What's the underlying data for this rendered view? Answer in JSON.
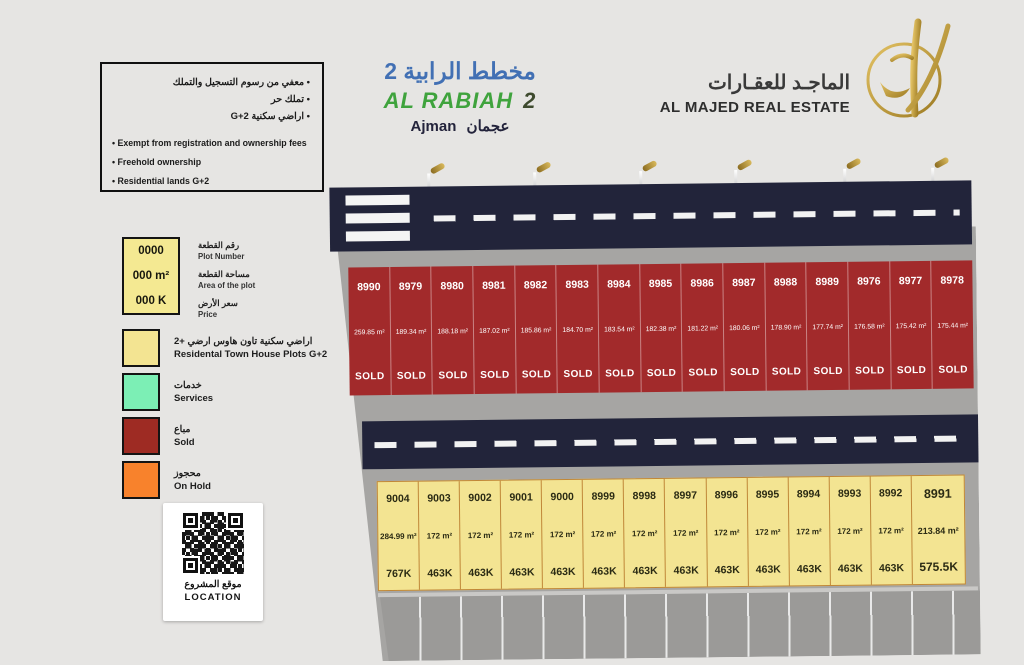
{
  "info_box": {
    "lines_ar": [
      "معفي من رسوم التسجيل والتملك",
      "تملك حر",
      "اراضي سكنية G+2"
    ],
    "lines_en": [
      "Exempt from registration and ownership fees",
      "Freehold ownership",
      "Residential lands G+2"
    ]
  },
  "title": {
    "ar": "مخطط الرابية 2",
    "en": "AL RABIAH",
    "en_num": "2",
    "city": "عجمان  Ajman"
  },
  "brand": {
    "name_ar": "الماجـد للعقـارات",
    "name_en": "AL MAJED REAL ESTATE"
  },
  "legend": {
    "key": {
      "number": "0000",
      "area": "000 m²",
      "price": "000 K",
      "labels": [
        {
          "ar": "رقم القطعة",
          "en": "Plot Number"
        },
        {
          "ar": "مساحة القطعة",
          "en": "Area of the plot"
        },
        {
          "ar": "سعر الأرض",
          "en": "Price"
        }
      ]
    },
    "items": [
      {
        "color": "#F3E492",
        "ar": "اراضي سكنية تاون هاوس ارضي +2",
        "en": "Residental Town House Plots G+2"
      },
      {
        "color": "#7CEFB5",
        "ar": "خدمات",
        "en": "Services"
      },
      {
        "color": "#9E2B23",
        "ar": "مباع",
        "en": "Sold"
      },
      {
        "color": "#F8822C",
        "ar": "محجوز",
        "en": "On Hold"
      }
    ]
  },
  "qr": {
    "ar": "موقع المشروع",
    "en": "LOCATION"
  },
  "map": {
    "street_light_count": 6,
    "sold_row": [
      {
        "id": "8990",
        "area": "259.85 m²",
        "status": "SOLD"
      },
      {
        "id": "8979",
        "area": "189.34 m²",
        "status": "SOLD"
      },
      {
        "id": "8980",
        "area": "188.18 m²",
        "status": "SOLD"
      },
      {
        "id": "8981",
        "area": "187.02 m²",
        "status": "SOLD"
      },
      {
        "id": "8982",
        "area": "185.86 m²",
        "status": "SOLD"
      },
      {
        "id": "8983",
        "area": "184.70 m²",
        "status": "SOLD"
      },
      {
        "id": "8984",
        "area": "183.54 m²",
        "status": "SOLD"
      },
      {
        "id": "8985",
        "area": "182.38 m²",
        "status": "SOLD"
      },
      {
        "id": "8986",
        "area": "181.22 m²",
        "status": "SOLD"
      },
      {
        "id": "8987",
        "area": "180.06 m²",
        "status": "SOLD"
      },
      {
        "id": "8988",
        "area": "178.90 m²",
        "status": "SOLD"
      },
      {
        "id": "8989",
        "area": "177.74 m²",
        "status": "SOLD"
      },
      {
        "id": "8976",
        "area": "176.58 m²",
        "status": "SOLD"
      },
      {
        "id": "8977",
        "area": "175.42 m²",
        "status": "SOLD"
      },
      {
        "id": "8978",
        "area": "175.44 m²",
        "status": "SOLD"
      }
    ],
    "available_row": [
      {
        "id": "9004",
        "area": "284.99 m²",
        "price": "767K"
      },
      {
        "id": "9003",
        "area": "172 m²",
        "price": "463K"
      },
      {
        "id": "9002",
        "area": "172 m²",
        "price": "463K"
      },
      {
        "id": "9001",
        "area": "172 m²",
        "price": "463K"
      },
      {
        "id": "9000",
        "area": "172 m²",
        "price": "463K"
      },
      {
        "id": "8999",
        "area": "172 m²",
        "price": "463K"
      },
      {
        "id": "8998",
        "area": "172 m²",
        "price": "463K"
      },
      {
        "id": "8997",
        "area": "172 m²",
        "price": "463K"
      },
      {
        "id": "8996",
        "area": "172 m²",
        "price": "463K"
      },
      {
        "id": "8995",
        "area": "172 m²",
        "price": "463K"
      },
      {
        "id": "8994",
        "area": "172 m²",
        "price": "463K"
      },
      {
        "id": "8993",
        "area": "172 m²",
        "price": "463K"
      },
      {
        "id": "8992",
        "area": "172 m²",
        "price": "463K"
      },
      {
        "id": "8991",
        "area": "213.84 m²",
        "price": "575.5K"
      }
    ]
  },
  "colors": {
    "road": "#22243A",
    "ground": "#A6A5A3",
    "sold_plot": "#A22A2B",
    "available_plot": "#F3E492",
    "services": "#7CEFB5",
    "on_hold": "#F8822C",
    "title_blue": "#4270B4",
    "title_green": "#3FA33D",
    "brand_gold": "#C9A23A"
  }
}
